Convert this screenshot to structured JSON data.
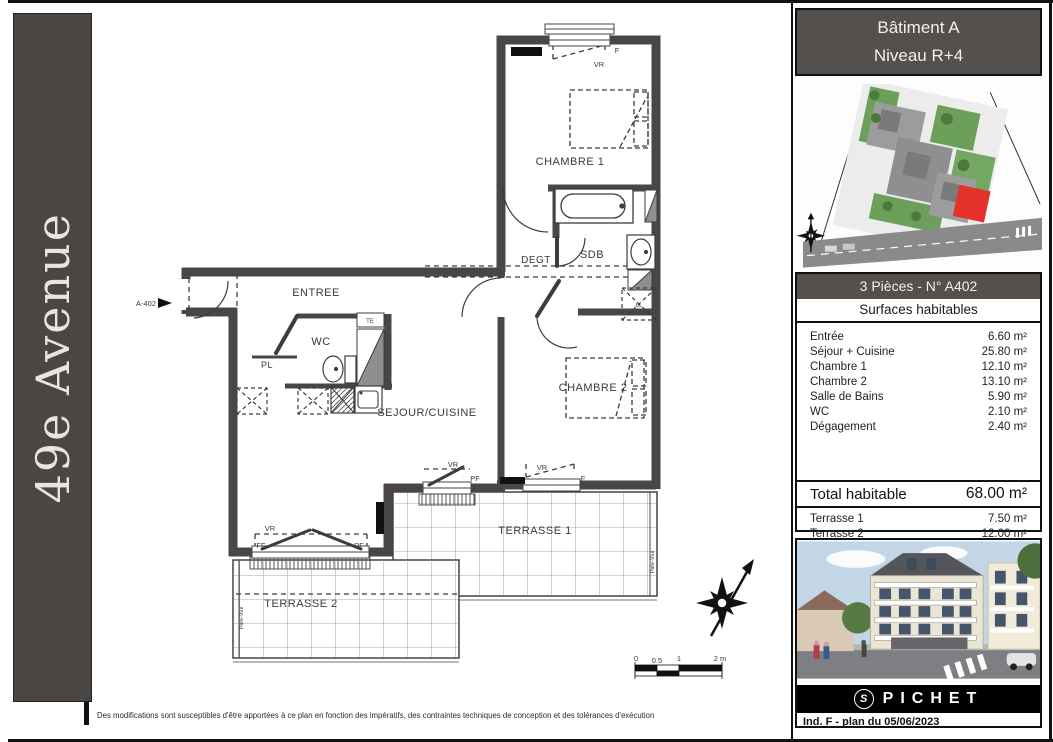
{
  "banner": {
    "title": "49e Avenue"
  },
  "plan": {
    "labels": {
      "unit": "A-402",
      "chambre1": "CHAMBRE 1",
      "chambre2": "CHAMBRE 2",
      "sdb": "SDB",
      "degt": "DEGT",
      "entree": "ENTREE",
      "wc": "WC",
      "pl": "PL",
      "sejour": "SEJOUR/CUISINE",
      "terrasse1": "TERRASSE 1",
      "terrasse2": "TERRASSE 2",
      "ll": "LL",
      "te": "TE",
      "pare_vue": "Pare-Vue",
      "vr": "VR",
      "ff": "FF",
      "pf": "PF",
      "f": "F"
    },
    "scale": {
      "z": "0",
      "h": "0.5",
      "one": "1",
      "two": "2 m"
    }
  },
  "sidebar": {
    "building": "Bâtiment A",
    "level": "Niveau R+4",
    "unit_header": "3 Pièces - N° A402",
    "surfaces_title": "Surfaces habitables",
    "rows": [
      {
        "label": "Entrée",
        "value": "6.60 m²"
      },
      {
        "label": "Séjour + Cuisine",
        "value": "25.80 m²"
      },
      {
        "label": "Chambre 1",
        "value": "12.10 m²"
      },
      {
        "label": "Chambre 2",
        "value": "13.10 m²"
      },
      {
        "label": "Salle de Bains",
        "value": "5.90 m²"
      },
      {
        "label": "WC",
        "value": "2.10 m²"
      },
      {
        "label": "Dégagement",
        "value": "2.40 m²"
      }
    ],
    "total_label": "Total habitable",
    "total_value": "68.00 m²",
    "terraces": [
      {
        "label": "Terrasse 1",
        "value": "7.50 m²"
      },
      {
        "label": "Terrasse 2",
        "value": "12.00 m²"
      }
    ],
    "brand": "PICHET",
    "brand_mark": "S",
    "revision": "Ind. F - plan du 05/06/2023"
  },
  "footer": {
    "disclaimer": "Des modifications sont susceptibles d'être apportées à ce plan en fonction des impératifs, des contraintes techniques de conception et des tolérances d'exécution"
  },
  "colors": {
    "wall": "#4a4644",
    "highlight_red": "#e5312b",
    "header_bg": "#53504d"
  }
}
